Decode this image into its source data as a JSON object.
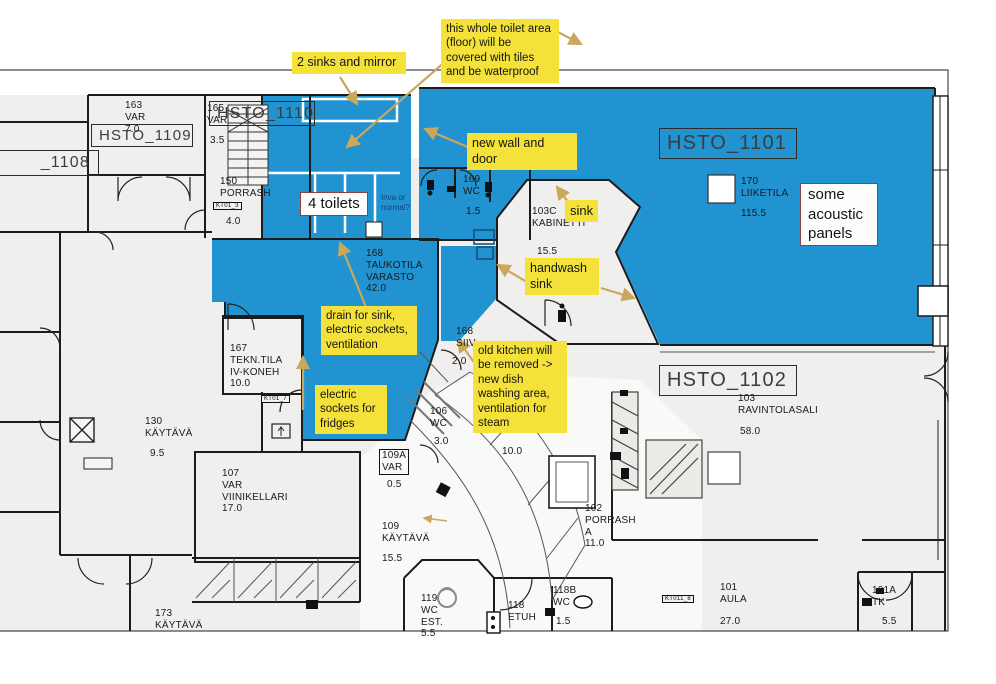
{
  "colors": {
    "highlight_blue": "#2193d0",
    "note_yellow": "#f4e23b",
    "arrow_tan": "#c9a85c",
    "callout_border_red": "#8d4441",
    "plan_gray": "#f0efed",
    "wall_black": "#1c1c1c"
  },
  "zones": {
    "hsto_1108": "_1108",
    "hsto_1109": "HSTO_1109",
    "hsto_1110": "HSTO_1110",
    "hsto_1101": "HSTO_1101",
    "hsto_1102": "HSTO_1102"
  },
  "rooms": [
    {
      "id": "163-var",
      "label": "163\nVAR\n7.0"
    },
    {
      "id": "165-var",
      "label": "165\nVAR"
    },
    {
      "id": "165-area",
      "label": "3.5"
    },
    {
      "id": "150-porrash",
      "label": "150\nPORRASH"
    },
    {
      "id": "150-area",
      "label": "4.0"
    },
    {
      "id": "169-wc",
      "label": "169\nWC"
    },
    {
      "id": "169-area",
      "label": "1.5"
    },
    {
      "id": "103c-kabinetti",
      "label": "103C\nKABINETTI"
    },
    {
      "id": "103c-area",
      "label": "15.5"
    },
    {
      "id": "170-liiketila",
      "label": "170\nLIIKETILA"
    },
    {
      "id": "170-area",
      "label": "115.5"
    },
    {
      "id": "168-taukotila",
      "label": "168\nTAUKOTILA\nVARASTO\n42.0"
    },
    {
      "id": "168-siiv",
      "label": "168\nSIIV"
    },
    {
      "id": "168-siiv-area",
      "label": "2.0"
    },
    {
      "id": "167-tekntila",
      "label": "167\nTEKN.TILA\nIV-KONEH\n10.0"
    },
    {
      "id": "106-wc",
      "label": "106\nWC"
    },
    {
      "id": "106-area",
      "label": "3.0"
    },
    {
      "id": "105-area",
      "label": "10.0"
    },
    {
      "id": "130-kaytava",
      "label": "130\nKÄYTÄVÄ"
    },
    {
      "id": "130-area",
      "label": "9.5"
    },
    {
      "id": "107-viinikellari",
      "label": "107\nVAR\nVIINIKELLARI\n17.0"
    },
    {
      "id": "109a-var",
      "label": "109A\nVAR"
    },
    {
      "id": "109a-area",
      "label": "0.5"
    },
    {
      "id": "109-kaytava",
      "label": "109\nKÄYTÄVÄ"
    },
    {
      "id": "109-area",
      "label": "15.5"
    },
    {
      "id": "173-kaytava",
      "label": "173\nKÄYTÄVÄ"
    },
    {
      "id": "102-porrash",
      "label": "102\nPORRASH\nA\n11.0"
    },
    {
      "id": "103-ravintolasali",
      "label": "103\nRAVINTOLASALI"
    },
    {
      "id": "103-area",
      "label": "58.0"
    },
    {
      "id": "119-wc",
      "label": "119\nWC\nEST.\n5.5"
    },
    {
      "id": "118-etuh",
      "label": "118\nETUH"
    },
    {
      "id": "118b-wc",
      "label": "118B\nWC"
    },
    {
      "id": "118b-area",
      "label": "1.5"
    },
    {
      "id": "101-aula",
      "label": "101\nAULA"
    },
    {
      "id": "101-area",
      "label": "27.0"
    },
    {
      "id": "101a-tk",
      "label": "101A\nTK"
    },
    {
      "id": "101a-area",
      "label": "5.5"
    }
  ],
  "handwriting": {
    "inva_question": "Inva or\nnormal?"
  },
  "notes": [
    {
      "id": "sinks-mirror",
      "text": "2 sinks and mirror"
    },
    {
      "id": "toilet-floor",
      "text": "this whole toilet area\n(floor) will be\ncovered with tiles\nand be waterproof"
    },
    {
      "id": "new-wall-door",
      "text": "new wall and door"
    },
    {
      "id": "sink",
      "text": "sink"
    },
    {
      "id": "handwash-sink",
      "text": "handwash\nsink"
    },
    {
      "id": "drain-sockets",
      "text": "drain for sink,\nelectric sockets,\nventilation"
    },
    {
      "id": "sockets-fridges",
      "text": "electric\nsockets for\nfridges"
    },
    {
      "id": "old-kitchen",
      "text": "old kitchen will\nbe removed ->\nnew dish\nwashing area,\nventilation for\nsteam"
    }
  ],
  "callouts": [
    {
      "id": "four-toilets",
      "text": "4 toilets"
    },
    {
      "id": "acoustic-panels",
      "text": "some\nacoustic\npanels"
    }
  ],
  "badges": [
    {
      "id": "kt01-3",
      "text": "KT01_3"
    },
    {
      "id": "kt01-7",
      "text": "KT01_7"
    },
    {
      "id": "kt011-8",
      "text": "KT011_8"
    }
  ]
}
